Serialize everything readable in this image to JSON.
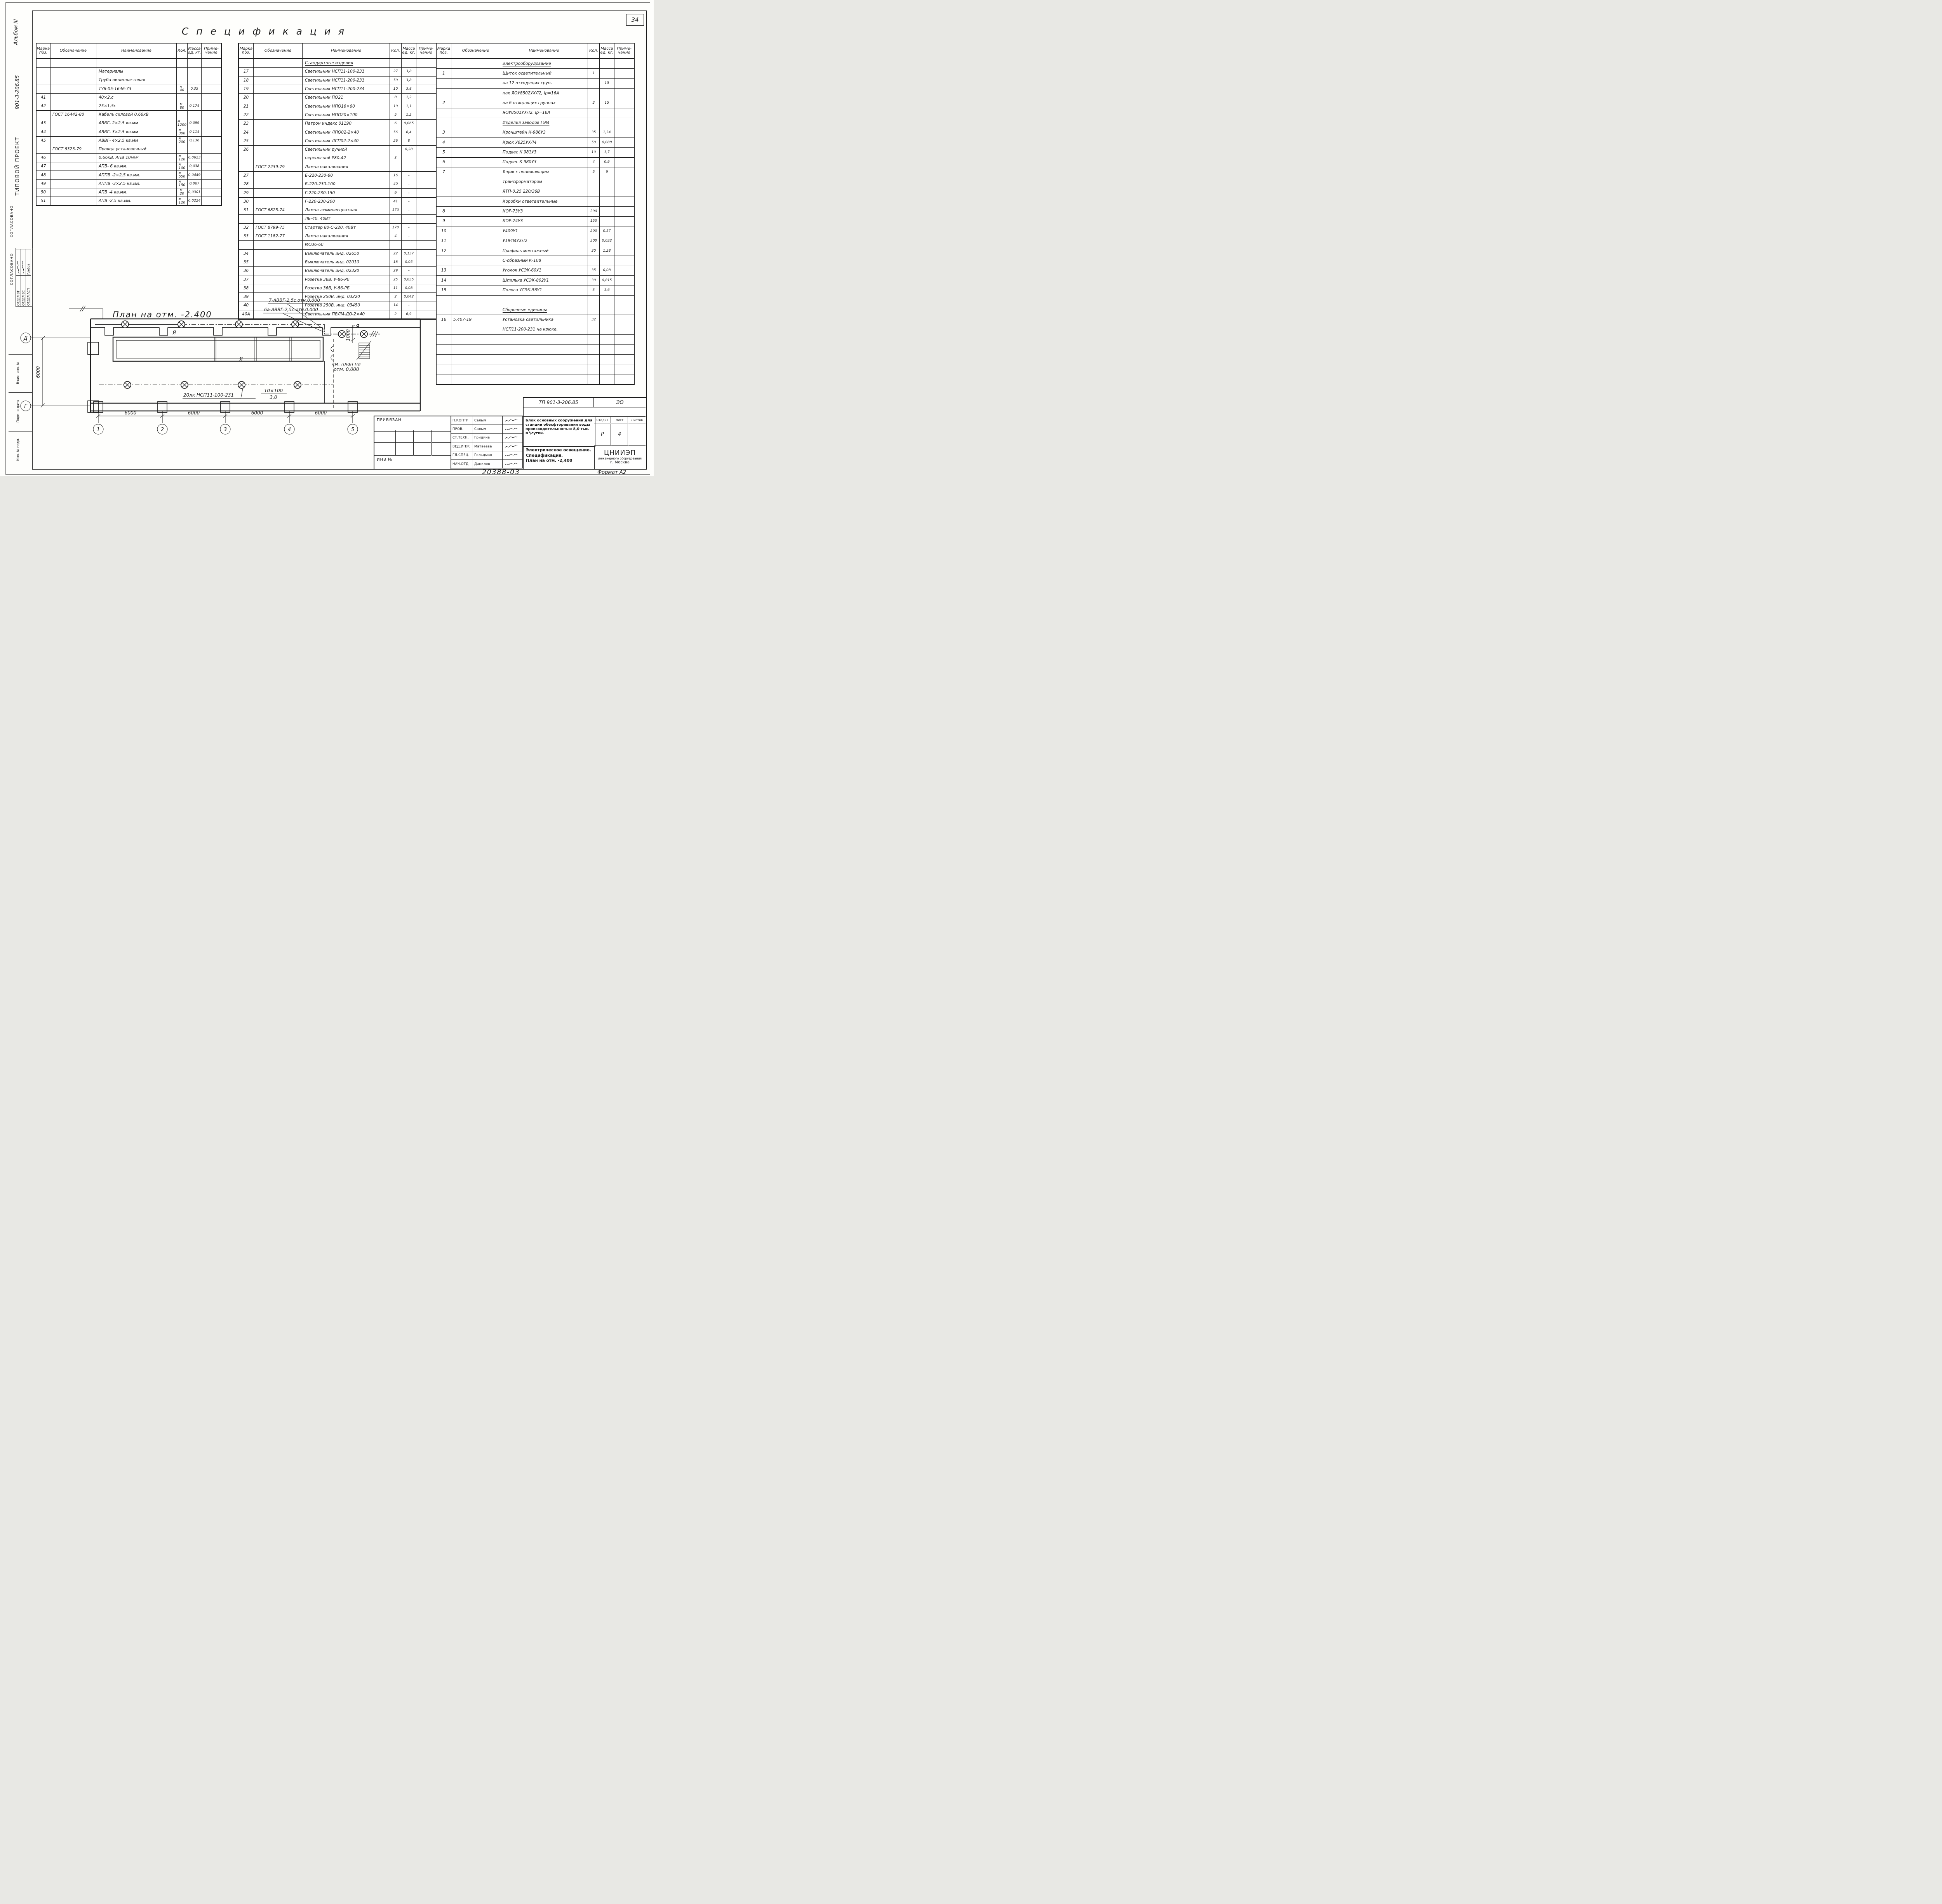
{
  "page": {
    "sheet_number": "34",
    "footer_num": "20388-03",
    "format": "Формат А2"
  },
  "sidebar": {
    "album": "Альбом III",
    "project_number": "901-3-206.85",
    "project_type": "Типовой проект",
    "agreed1": "СОГЛАСОВАНО",
    "agreed2": "СОГЛАСОВАНО",
    "departments": [
      {
        "label": "ОТДЕЛ ВТ",
        "name": ""
      },
      {
        "label": "ОТДЕЛ ВС",
        "name": ""
      },
      {
        "label": "ОТДЕЛ АСП",
        "name": "Глебов"
      }
    ],
    "stamps": [
      "Взам. инв. №",
      "Подп. и дата",
      "Инв. № подл."
    ]
  },
  "title": "С п е ц и ф и к а ц и я",
  "columns": {
    "pos": "Марка\nпоз.",
    "designation": "Обозначение",
    "name": "Наименование",
    "qty": "Кол.",
    "mass": "Масса\nед. кг.",
    "note": "Приме-\nчание"
  },
  "tables": [
    {
      "rows": [
        {},
        {
          "name": "Материалы",
          "u": 1
        },
        {
          "name": "Труба винипластовая"
        },
        {
          "name": "ТУ6-05-1646-73",
          "qty": "м\n40",
          "mass": "0,35"
        },
        {
          "pos": "41",
          "name": "40×2,с"
        },
        {
          "pos": "42",
          "name": "25×1,5с",
          "qty": "м\n80",
          "mass": "0,174"
        },
        {
          "des": "ГОСТ 16442-80",
          "name": "Кабель силовой 0,66кВ"
        },
        {
          "pos": "43",
          "name": "АВВГ- 2×2,5 кв.мм",
          "qty": "м\n1200",
          "mass": "0,099"
        },
        {
          "pos": "44",
          "name": "АВВГ- 3×2,5 кв.мм",
          "qty": "м\n300",
          "mass": "0,114"
        },
        {
          "pos": "45",
          "name": "АВВГ- 4×2,5 кв.мм",
          "qty": "м\n200",
          "mass": "0,136"
        },
        {
          "des": "ГОСТ 6323-79",
          "name": "Провод установочный"
        },
        {
          "pos": "46",
          "name": "0,66кВ, АПВ 10мм²",
          "qty": "м\n120",
          "mass": "0,0623"
        },
        {
          "pos": "47",
          "name": "АПВ- 6 кв.мм.",
          "qty": "м\n100",
          "mass": "0,038"
        },
        {
          "pos": "48",
          "name": "АППВ -2×2,5 кв.мм.",
          "qty": "м\n550",
          "mass": "0,0449"
        },
        {
          "pos": "49",
          "name": "АППВ -3×2,5 кв.мм.",
          "qty": "м\n150",
          "mass": "0,067"
        },
        {
          "pos": "50",
          "name": "АПВ -4 кв.мм.",
          "qty": "м\n20",
          "mass": "0,0301"
        },
        {
          "pos": "51",
          "name": "АПВ -2,5 кв.мм.",
          "qty": "м\n120",
          "mass": "0,0224"
        }
      ]
    },
    {
      "rows": [
        {
          "name": "Стандартные изделия",
          "u": 1
        },
        {
          "pos": "17",
          "name": "Светильник НСП11-100-231",
          "qty": "27",
          "mass": "3,8"
        },
        {
          "pos": "18",
          "name": "Светильник НСП11-200-231",
          "qty": "50",
          "mass": "3,8"
        },
        {
          "pos": "19",
          "name": "Светильник НСП11-200-234",
          "qty": "10",
          "mass": "3,8"
        },
        {
          "pos": "20",
          "name": "Светильник ПО21",
          "qty": "8",
          "mass": "1,2"
        },
        {
          "pos": "21",
          "name": "Светильник НПО16×60",
          "qty": "10",
          "mass": "1,1"
        },
        {
          "pos": "22",
          "name": "Светильник НПО20×100",
          "qty": "5",
          "mass": "1,2"
        },
        {
          "pos": "23",
          "name": "Патрон индекс 01190",
          "qty": "6",
          "mass": "0,065"
        },
        {
          "pos": "24",
          "name": "Светильник ЛПО02-2×40",
          "qty": "56",
          "mass": "6,4"
        },
        {
          "pos": "25",
          "name": "Светильник ЛСП02-2×40",
          "qty": "26",
          "mass": "8"
        },
        {
          "pos": "26",
          "name": "Светильник ручной",
          "mass": "0,28"
        },
        {
          "name": "переносной Р80-42",
          "qty": "3"
        },
        {
          "des": "ГОСТ 2239-79",
          "name": "Лампа накаливания"
        },
        {
          "pos": "27",
          "name": "Б-220-230-60",
          "qty": "16",
          "mass": "–"
        },
        {
          "pos": "28",
          "name": "Б-220-230-100",
          "qty": "40",
          "mass": "–"
        },
        {
          "pos": "29",
          "name": "Г-220-230-150",
          "qty": "9",
          "mass": "–"
        },
        {
          "pos": "30",
          "name": "Г-220-230-200",
          "qty": "41",
          "mass": "–"
        },
        {
          "pos": "31",
          "des": "ГОСТ 6825-74",
          "name": "Лампа люминесцентная",
          "qty": "170",
          "mass": "–"
        },
        {
          "name": "ЛБ-40, 40Вт"
        },
        {
          "pos": "32",
          "des": "ГОСТ 8799-75",
          "name": "Стартер 80-С-220, 40Вт",
          "qty": "170",
          "mass": "–"
        },
        {
          "pos": "33",
          "des": "ГОСТ 1182-77",
          "name": "Лампа накаливания",
          "qty": "4",
          "mass": "–"
        },
        {
          "name": "МО36-60"
        },
        {
          "pos": "34",
          "name": "Выключатель инд. 02650",
          "qty": "22",
          "mass": "0,137"
        },
        {
          "pos": "35",
          "name": "Выключатель инд. 02010",
          "qty": "18",
          "mass": "0,05"
        },
        {
          "pos": "36",
          "name": "Выключатель инд. 02320",
          "qty": "29",
          "mass": "–"
        },
        {
          "pos": "37",
          "name": "Розетка 36В, У-86-Р0",
          "qty": "25",
          "mass": "0,035"
        },
        {
          "pos": "38",
          "name": "Розетка 36В, У-86-РБ",
          "qty": "11",
          "mass": "0,08"
        },
        {
          "pos": "39",
          "name": "Розетка 250В, инд. 03220",
          "qty": "2",
          "mass": "0,042"
        },
        {
          "pos": "40",
          "name": "Розетка 250В, инд. 03450",
          "qty": "14",
          "mass": "–"
        },
        {
          "pos": "40А",
          "name": "Светильник ПВЛМ-ДО-2×40",
          "qty": "2",
          "mass": "6,9"
        }
      ]
    },
    {
      "rows": [
        {
          "name": "Электрооборудование",
          "u": 1
        },
        {
          "pos": "1",
          "name": "Щиток осветительный",
          "qty": "1"
        },
        {
          "name": "на 12 отходящих груп-",
          "mass": "15"
        },
        {
          "name": "пах ЯОУ8502УХЛ2, Iр=16А"
        },
        {
          "pos": "2",
          "name": "на 6 отходящих группах",
          "qty": "2",
          "mass": "15"
        },
        {
          "name": "ЯОУ8501УХЛ2, Iр=16А"
        },
        {
          "name": "Изделия заводов ГЭМ",
          "u": 1
        },
        {
          "pos": "3",
          "name": "Кронштейн К-986У3",
          "qty": "35",
          "mass": "1,34"
        },
        {
          "pos": "4",
          "name": "Крюк У625УХЛ4",
          "qty": "50",
          "mass": "0,088"
        },
        {
          "pos": "5",
          "name": "Подвес К 981У3",
          "qty": "10",
          "mass": "1,7"
        },
        {
          "pos": "6",
          "name": "Подвес К 980У3",
          "qty": "4",
          "mass": "0,9"
        },
        {
          "pos": "7",
          "name": "Ящик с понижающим",
          "qty": "5",
          "mass": "9"
        },
        {
          "name": "трансформатором"
        },
        {
          "name": "ЯТП-0,25 220/36В"
        },
        {
          "name": "Коробки ответвительные"
        },
        {
          "pos": "8",
          "name": "КОР-73У3",
          "qty": "200"
        },
        {
          "pos": "9",
          "name": "КОР-74У3",
          "qty": "150"
        },
        {
          "pos": "10",
          "name": "У409У1",
          "qty": "200",
          "mass": "0,57"
        },
        {
          "pos": "11",
          "name": "У194МУХЛ2",
          "qty": "300",
          "mass": "0,032"
        },
        {
          "pos": "12",
          "name": "Профиль монтажный",
          "qty": "30",
          "mass": "1,28"
        },
        {
          "name": "С-образный К-108"
        },
        {
          "pos": "13",
          "name": "Уголок УСЭК-60У1",
          "qty": "35",
          "mass": "0,08"
        },
        {
          "pos": "14",
          "name": "Шпилька УСЭК-802У1",
          "qty": "30",
          "mass": "0,815"
        },
        {
          "pos": "15",
          "name": "Полоса УСЭК-56У1",
          "qty": "3",
          "mass": "1,6"
        },
        {},
        {
          "name": "Сборочные единицы",
          "u": 1
        },
        {
          "pos": "16",
          "des": "5.407-19",
          "name": "Установка светильника",
          "qty": "32"
        },
        {
          "name": "НСП11-200-231 на крюке."
        },
        {},
        {},
        {},
        {},
        {}
      ]
    }
  ],
  "plan": {
    "title": "План на отм. -2.400",
    "callout1": "7-АВВГ-2,5с отн.0.000",
    "callout2": "6а-АВВГ-2,5с отн.0.000",
    "lamp_note": "20лк НСП11-100-231",
    "frac_top": "10×100",
    "frac_bot": "3,0",
    "see_plan_1": "см. план на",
    "see_plan_2": "отм. 0,000",
    "dim_6000": "6000",
    "dim_1000": "1000",
    "group_label": "Я",
    "axis_rows": [
      "Д",
      "Г"
    ],
    "axis_cols": [
      "1",
      "2",
      "3",
      "4",
      "5"
    ]
  },
  "titleblock": {
    "privyazan": "ПРИВЯЗАН",
    "inv_no": "ИНВ.№",
    "doc": "ТП 901-3-206.85",
    "mark": "ЭО",
    "roles": [
      {
        "role": "Н.КОНТР",
        "name": "Салым"
      },
      {
        "role": "ПРОВ.",
        "name": "Салым"
      },
      {
        "role": "СТ.ТЕХН.",
        "name": "Грицина"
      },
      {
        "role": "ВЕД.ИНЖ",
        "name": "Матвеева"
      },
      {
        "role": "ГЛ.СПЕЦ.",
        "name": "Гольцман"
      },
      {
        "role": "НАЧ.ОТД",
        "name": "Данилов"
      }
    ],
    "project": "Блок основных сооружений для станции обесфторивания воды производительностью 8,0 тыс. м³/сутки.",
    "stage_h": [
      "Стадия",
      "Лист",
      "Листов"
    ],
    "stage": "Р",
    "sheet": "4",
    "sheets_total": "",
    "sheet_title_1": "Электрическое освещение.",
    "sheet_title_2": "Спецификация.",
    "sheet_title_3": "План на отм. -2,400",
    "org1": "ЦНИИЭП",
    "org2": "инженерного оборудования",
    "org3": "г. Москва"
  }
}
